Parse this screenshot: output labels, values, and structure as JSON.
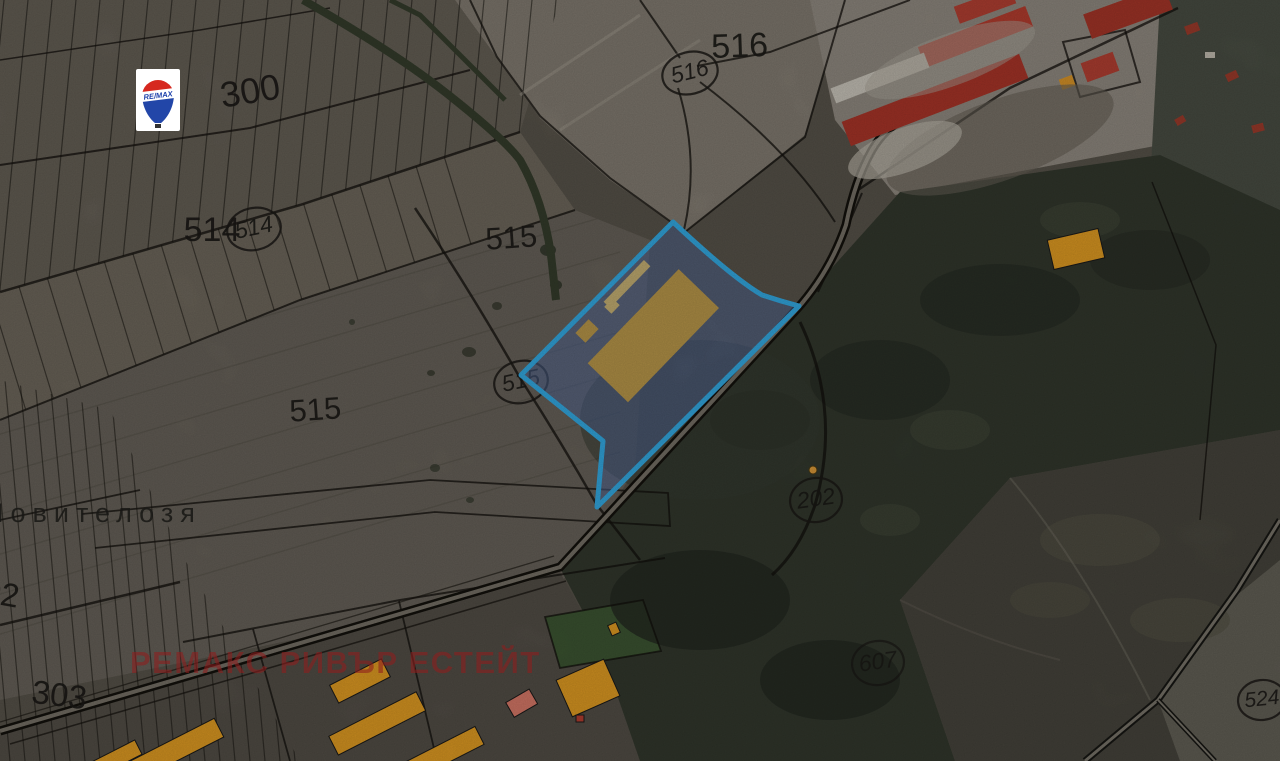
{
  "map": {
    "type": "cadastral-satellite-map",
    "watermark": {
      "text": "РЕМАКС РИВЪР ЕСТЕЙТ",
      "color": "#8f1d1d"
    },
    "place": {
      "text": "Новителозя"
    },
    "logo": {
      "brand": "RE/MAX"
    },
    "labels": {
      "parcels": [
        {
          "text": "300"
        },
        {
          "text": "516"
        },
        {
          "text": "514"
        },
        {
          "text": "515"
        },
        {
          "text": "515"
        },
        {
          "text": "302"
        },
        {
          "text": "303"
        }
      ],
      "roads": [
        {
          "text": "516"
        },
        {
          "text": "514"
        },
        {
          "text": "515"
        },
        {
          "text": "202"
        },
        {
          "text": "607"
        },
        {
          "text": "524"
        }
      ]
    },
    "highlight": {
      "border_color": "#38b6f4",
      "fill_color": "rgba(86,112,164,0.55)",
      "building_color": "#c6a250"
    },
    "colors": {
      "farm_building_yellow": "#f0a726",
      "roof_red": "#b5392c",
      "salmon_building": "#e88270",
      "boundary_black": "#14120e"
    }
  }
}
